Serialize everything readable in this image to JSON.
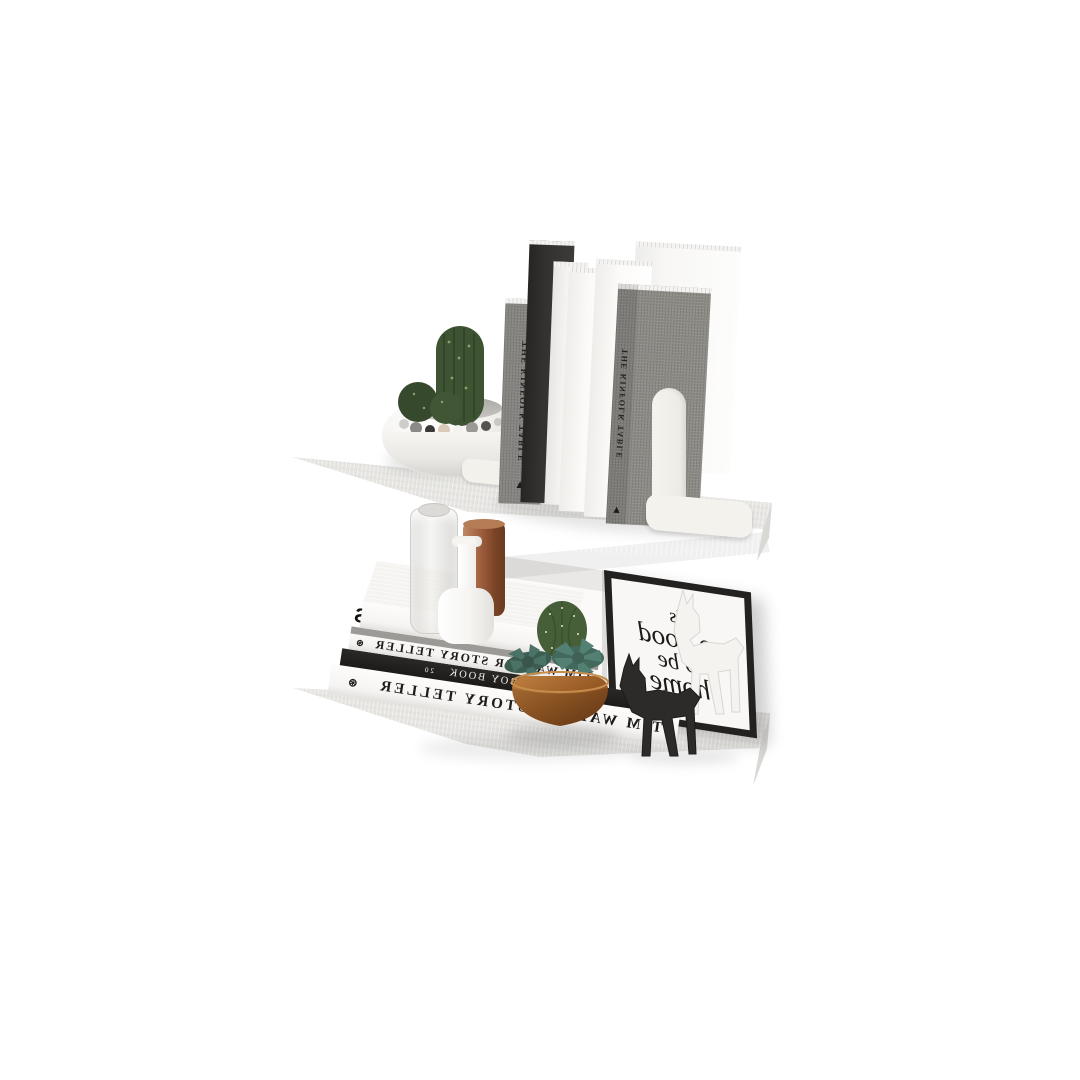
{
  "scene": {
    "type": "product photo",
    "subject": "2-tier white floating wall shelf styled with books and decor",
    "note": "photo is horizontally mirrored, printed text appears reversed",
    "background_color": "#ffffff",
    "shelf_color": "#e8e7e4",
    "accent_copper": "#9a5c38",
    "accent_wood": "#a0642e"
  },
  "top_shelf": {
    "planter": "white round pot with cacti and pebbles",
    "bookend": "white metal arch bookend",
    "books": [
      {
        "title": "THE KINFOLK TABLE",
        "logo": "▲",
        "style": "gray-linen"
      },
      {
        "title": "",
        "style": "black"
      },
      {
        "title": "",
        "style": "white"
      },
      {
        "title": "AMERICAN FASHION",
        "subtitle": "ACCESSORIES",
        "style": "white"
      },
      {
        "title": "GYPSET LIVING",
        "subtitle": "ECO HOUSES",
        "style": "white"
      },
      {
        "title": "THE KINFOLK TABLE",
        "logo": "▲",
        "style": "gray-linen"
      }
    ]
  },
  "bottom_shelf": {
    "stack": [
      {
        "title": "CARS",
        "logo": "⊛"
      },
      {
        "title": "TIM WALKER STORY TELLER",
        "logo": "⊛"
      },
      {
        "title": "THE PLAYBOY BOOK",
        "edition": "20"
      },
      {
        "title": "TIM WALKER STORY TELLER",
        "logo": "⊛"
      }
    ],
    "vases": [
      "clear glass bottle",
      "white ceramic bottle vase",
      "copper cylinder vase"
    ],
    "bowl": "wooden bowl with succulents and stones",
    "figurines": [
      "white deer figurine",
      "black deer figurine"
    ],
    "wall_art": {
      "text": "It's so good to be home",
      "lines": [
        "It's",
        "so good",
        "to be",
        "home"
      ],
      "frame_color": "#232221"
    }
  }
}
